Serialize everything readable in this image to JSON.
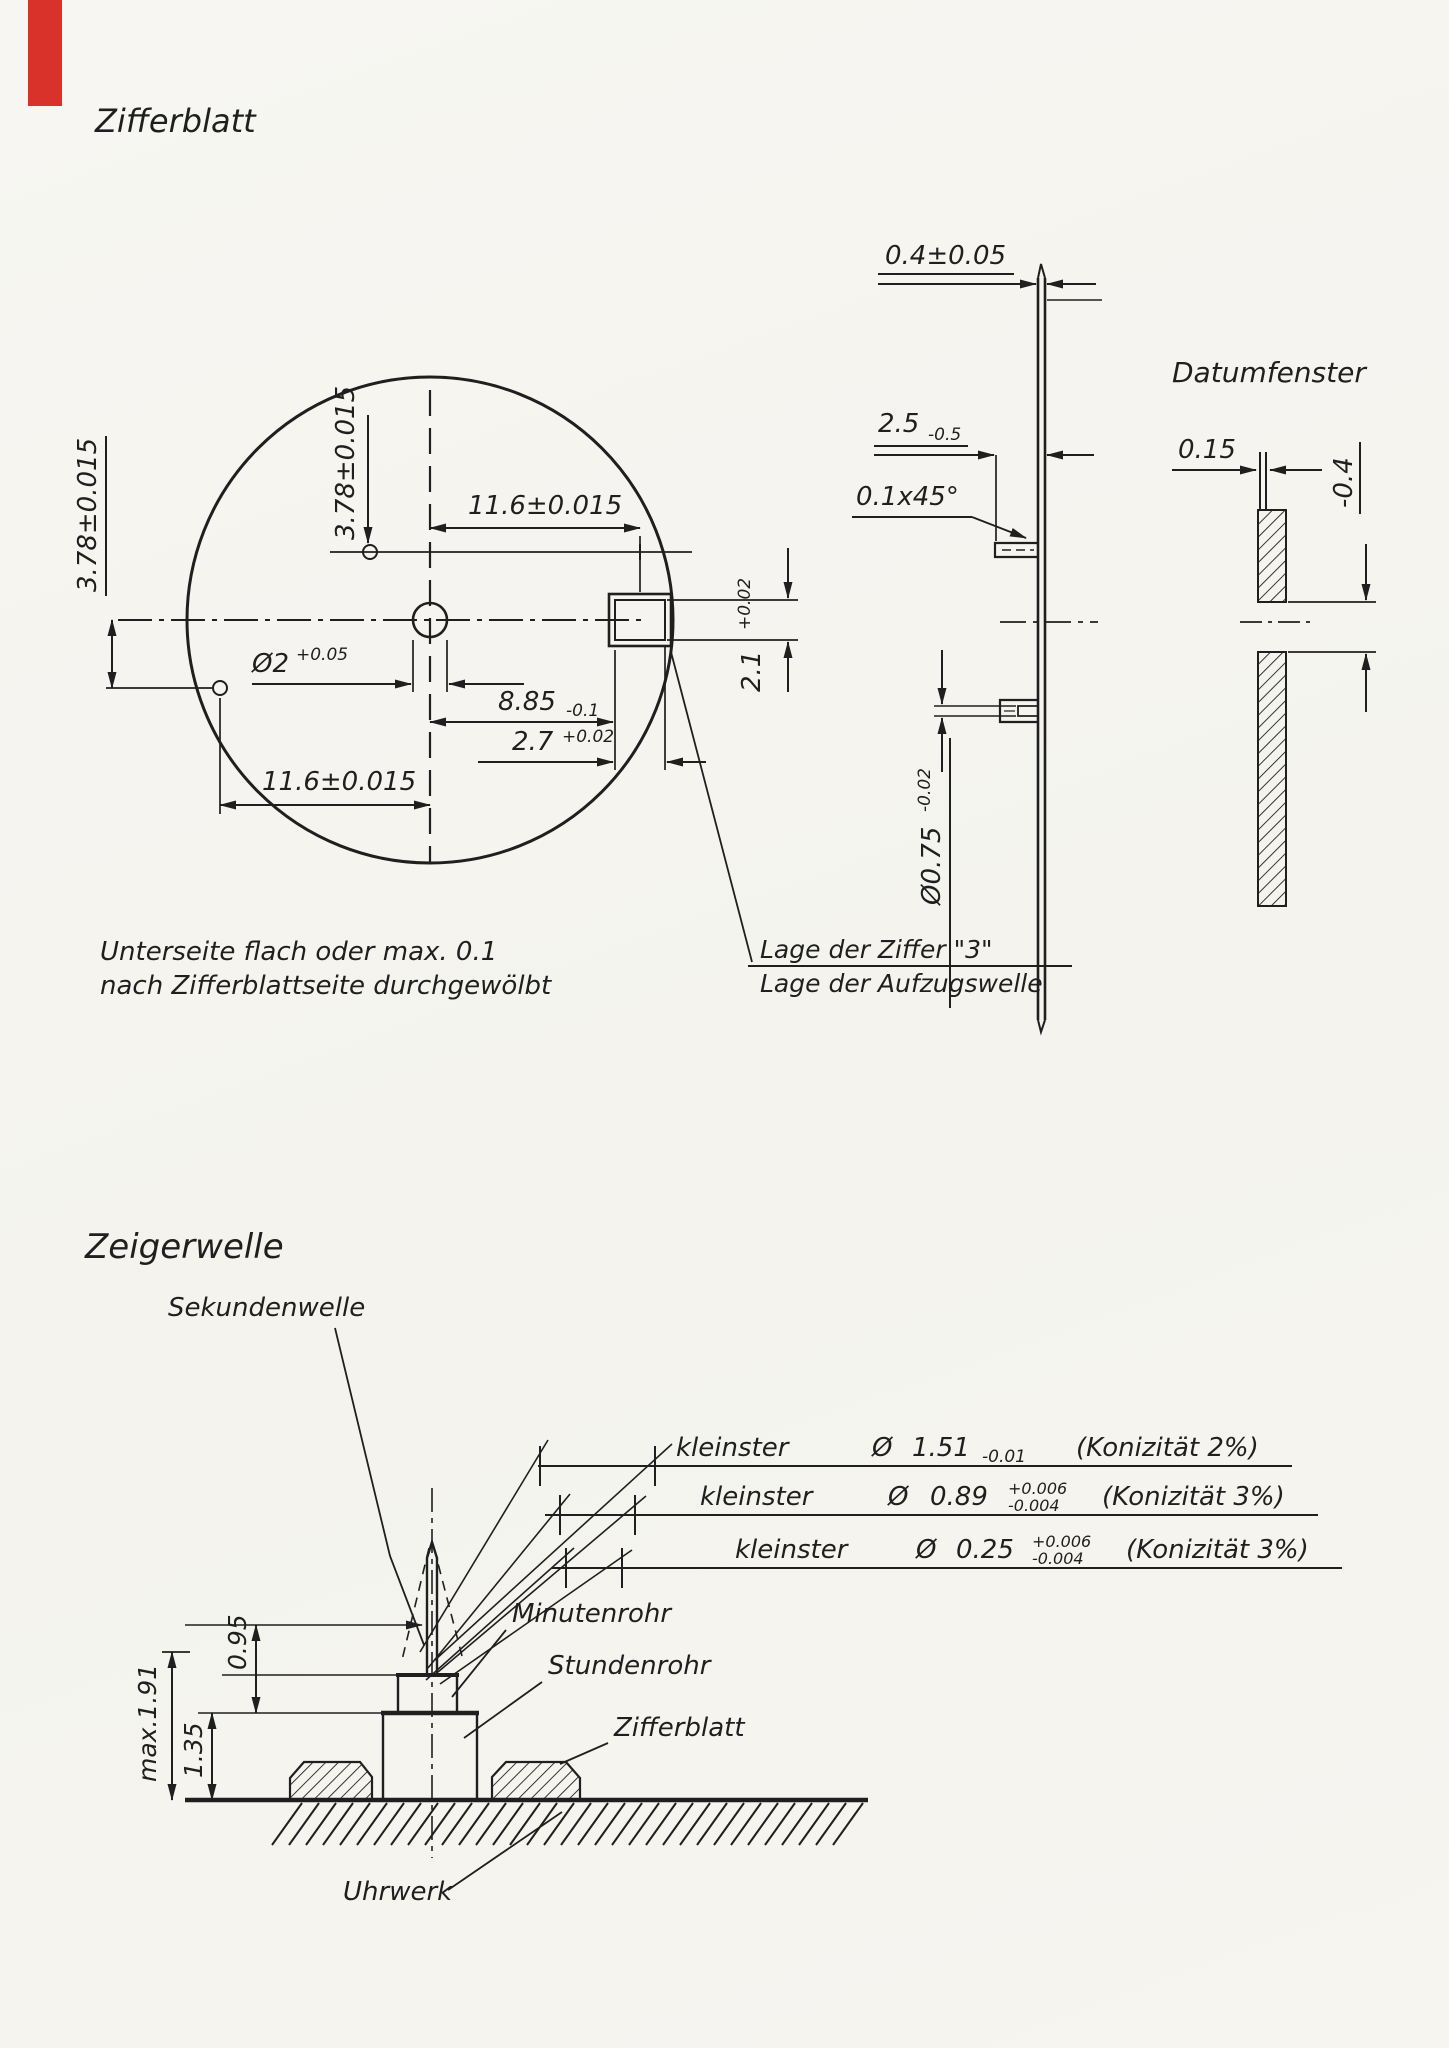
{
  "page": {
    "bg_color": "#f6f5f1",
    "ink_color": "#1f1f1f",
    "red_tab_color": "#d8322a"
  },
  "zifferblatt": {
    "title": "Zifferblatt",
    "front": {
      "dim_foot_left_vert": "3.78±0.015",
      "dim_foot_top_vert": "3.78±0.015",
      "dim_window_horiz": "11.6±0.015",
      "dim_foot_horiz": "11.6±0.015",
      "hole_dia": "Ø2",
      "hole_dia_tol": "+0.05",
      "dim_window_offset": "8.85",
      "dim_window_offset_tol": "-0.1",
      "dim_window_width": "2.7",
      "dim_window_width_tol": "+0.02",
      "dim_window_height": "2.1",
      "dim_window_height_tol": "+0.02",
      "note_line1": "Unterseite flach oder max. 0.1",
      "note_line2": "nach Zifferblattseite durchgewölbt",
      "callout_line1": "Lage der Ziffer \"3\"",
      "callout_line2": "Lage der Aufzugswelle"
    },
    "side": {
      "dim_thickness": "0.4±0.05",
      "dim_hub_offset": "2.5",
      "dim_hub_offset_tol": "-0.5",
      "dim_chamfer": "0.1x45°",
      "stem_dia": "Ø0.75",
      "stem_dia_tol": "-0.02"
    },
    "datumfenster": {
      "title": "Datumfenster",
      "dim_disc": "0.15",
      "dim_recess": "-0.4"
    }
  },
  "zeigerwelle": {
    "title": "Zeigerwelle",
    "taper_dims": [
      {
        "prefix": "kleinster",
        "dia": "Ø",
        "value": "1.51",
        "tol_upper": "",
        "tol_lower": "-0.01",
        "suffix": "(Konizität 2%)"
      },
      {
        "prefix": "kleinster",
        "dia": "Ø",
        "value": "0.89",
        "tol_upper": "+0.006",
        "tol_lower": "-0.004",
        "suffix": "(Konizität 3%)"
      },
      {
        "prefix": "kleinster",
        "dia": "Ø",
        "value": "0.25",
        "tol_upper": "+0.006",
        "tol_lower": "-0.004",
        "suffix": "(Konizität 3%)"
      }
    ],
    "labels": {
      "sekundenwelle": "Sekundenwelle",
      "minutenrohr": "Minutenrohr",
      "stundenrohr": "Stundenrohr",
      "zifferblatt": "Zifferblatt",
      "uhrwerk": "Uhrwerk"
    },
    "height_dims": {
      "total": "max.1.91",
      "hour": "1.35",
      "minute": "0.95"
    }
  }
}
